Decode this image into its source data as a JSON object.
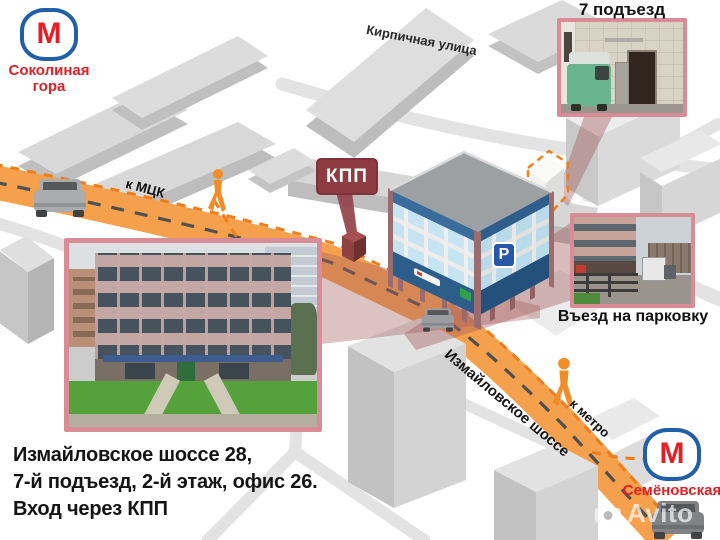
{
  "metro_top": {
    "letter": "М",
    "line1": "Соколиная",
    "line2": "гора"
  },
  "metro_bottom": {
    "letter": "М",
    "name": "Семёновская"
  },
  "labels": {
    "kirpichnaya": "Кирпичная улица",
    "to_mck": "к МЦК",
    "izmaylovskoe": "Измайловское шоссе",
    "to_metro": "к метро"
  },
  "badges": {
    "kpp": "КПП",
    "parking": "P"
  },
  "captions": {
    "entrance": "7 подъезд",
    "parking_entry": "Въезд на парковку"
  },
  "address": {
    "line1": "Измайловское шоссе 28,",
    "line2": "7-й подъезд, 2-й этаж, офис 26.",
    "line3": "Вход через КПП"
  },
  "watermark": {
    "text": "Avito"
  },
  "colors": {
    "road_orange": "#F5A04C",
    "route_dash_orange": "#EE7D1C",
    "metro_red": "#E31E24",
    "metro_blue": "#2160A8",
    "kpp_red": "#8E3C41",
    "callout_beam": "#A65E5E",
    "photo_border": "#D98C95",
    "parking_blue": "#2857A8",
    "pedestrian_orange": "#F28C26",
    "building_gray": "#D9D9D9",
    "office_band_blue": "#3A6C9C",
    "office_window_blue": "#C6E4F1"
  },
  "icons": {
    "metro": "metro-logo-icon",
    "pedestrian": "pedestrian-icon",
    "car": "car-icon",
    "parking": "parking-icon",
    "camera": "camera-icon"
  }
}
